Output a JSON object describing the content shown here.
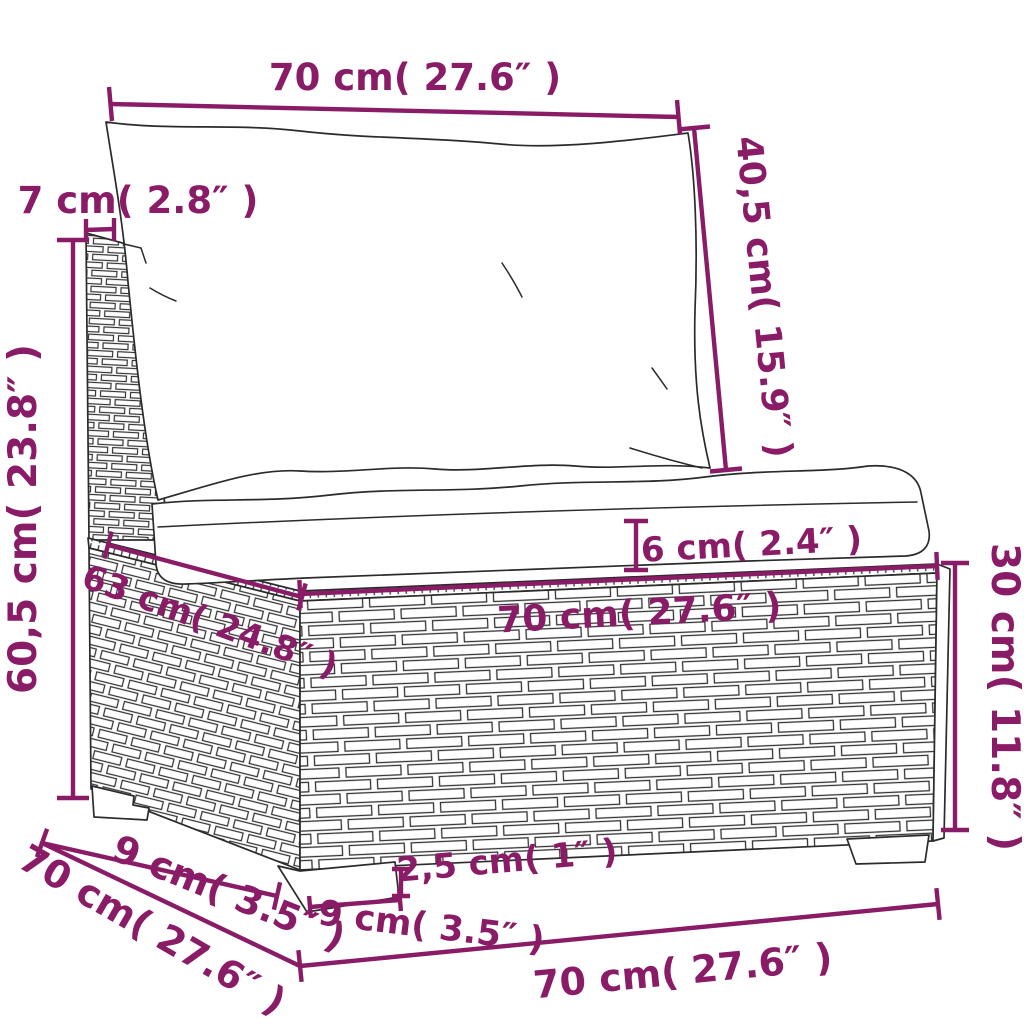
{
  "diagram": {
    "subject": "poly rattan garden sofa middle section with cushions - dimension drawing",
    "colors": {
      "dimension": "#8a1b67",
      "line": "#2b2b2b",
      "background": "#ffffff"
    },
    "dims": {
      "top_width": "70 cm( 27.6″ )",
      "back_panel_thickness": "7 cm( 2.8″ )",
      "back_cushion_height": "40,5 cm( 15.9″ )",
      "total_height": "60,5 cm( 23.8″ )",
      "seat_cushion_thickness": "6 cm( 2.4″ )",
      "seat_width": "70 cm( 27.6″ )",
      "seat_depth": "63 cm( 24.8″ )",
      "base_height": "30 cm( 11.8″ )",
      "left_foot_span": "9 cm( 3.5″ )",
      "base_depth": "70 cm( 27.6″ )",
      "foot_width": "9 cm( 3.5″ )",
      "foot_height": "2,5 cm( 1″ )",
      "base_width": "70 cm( 27.6″ )"
    }
  }
}
